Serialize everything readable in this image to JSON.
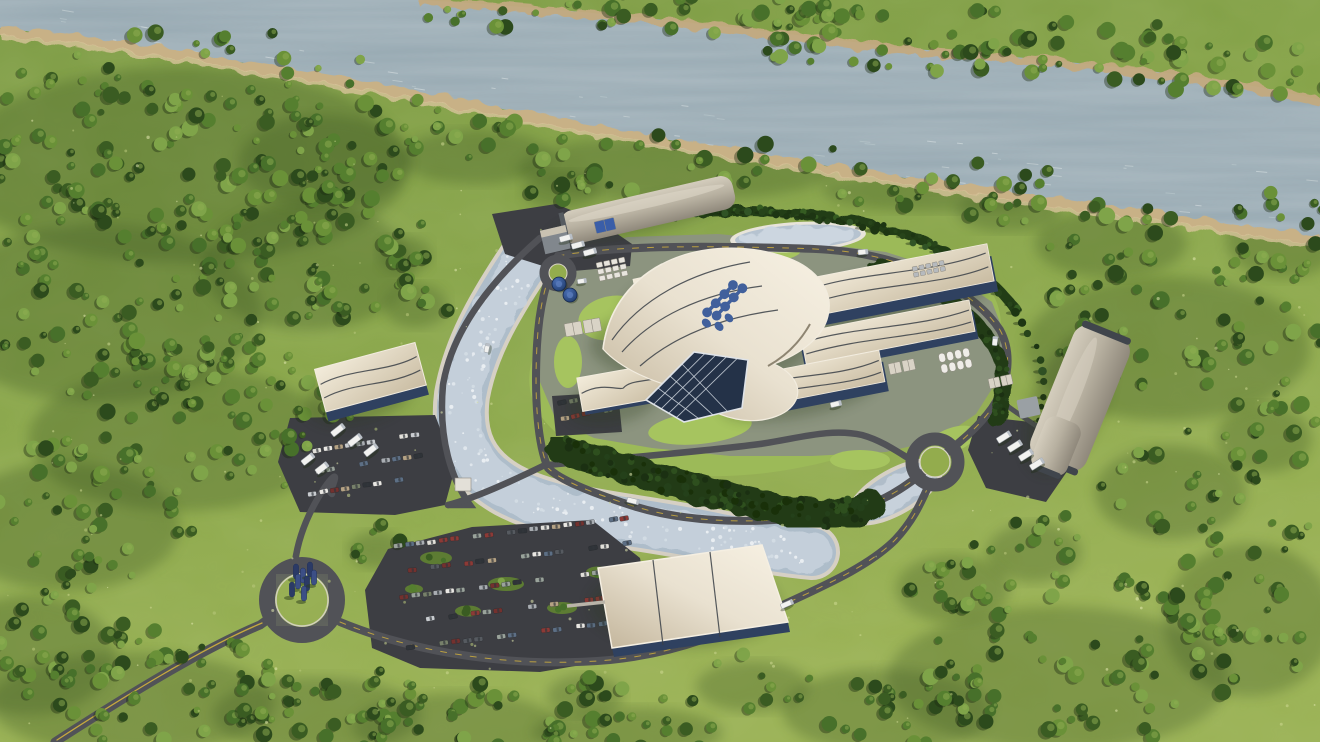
{
  "scene": {
    "name": "nuclear-plant-campus-aerial-render",
    "type": "3d-aerial-render",
    "description": "Photorealistic aerial 3D rendering of a small modular reactor power plant campus set in green countryside beside a wide river. An oval ring road encircles a central complex of cream wave-roofed buildings with a blue molecule logo on the main shell roof, a curved cooling channel, retention ponds, hedge bands, tall tree rows, gray vaulted warehouses with truck docks, a sail-roofed building, large car parks and three roundabouts, one with a blue sculpture. Dense forest surrounds the site and lines both river banks.",
    "seed": 20240817
  },
  "colors": {
    "grass_dark": "#7b9a43",
    "grass_mid": "#8aa74a",
    "grass_light": "#9ab254",
    "shadow_green": "#3a5422",
    "river_water": "#97a9b2",
    "river_light": "#c6d1d5",
    "shore_rock": "#c3aa80",
    "shore_sand": "#d8c49b",
    "far_forest": "#375722",
    "road_asphalt": "#515257",
    "road_line_yellow": "#d4b33c",
    "parking_asphalt": "#3d3e43",
    "campus_pad": "#8c947f",
    "campus_lawn": "#9cba58",
    "lawn_bright": "#a6c45f",
    "hedge_dark": "#223a16",
    "channel_stone": "#d6d0c4",
    "channel_water": "#aebdca",
    "channel_ice": "#c9d3dd",
    "roof_beige_light": "#efe8d6",
    "roof_beige": "#cdc0a8",
    "roof_seam": "#3a3f46",
    "glass_blue": "#2f4160",
    "hangar_gray": "#cfc8b9",
    "hangar_gray_dark": "#99927f",
    "container_white": "#e8e5de",
    "tank_blue": "#2e4f8e",
    "logo_blue": "#41609c",
    "sculpture_blue": "#3c4f86",
    "truck_white": "#f2f2f0"
  },
  "forest_patches": [
    [
      210,
      140,
      240,
      115,
      120
    ],
    [
      120,
      290,
      170,
      105,
      90
    ],
    [
      200,
      420,
      160,
      85,
      75
    ],
    [
      80,
      510,
      120,
      75,
      42
    ],
    [
      320,
      250,
      110,
      75,
      46
    ],
    [
      335,
      150,
      90,
      55,
      28
    ],
    [
      40,
      640,
      90,
      70,
      32
    ],
    [
      150,
      690,
      150,
      60,
      50
    ],
    [
      330,
      705,
      110,
      45,
      32
    ],
    [
      470,
      718,
      110,
      40,
      30
    ],
    [
      640,
      726,
      100,
      30,
      20
    ],
    [
      900,
      700,
      110,
      50,
      28
    ],
    [
      1080,
      660,
      180,
      85,
      70
    ],
    [
      1260,
      600,
      90,
      90,
      34
    ],
    [
      1180,
      480,
      80,
      55,
      24
    ],
    [
      1185,
      330,
      150,
      85,
      55
    ],
    [
      1120,
      235,
      80,
      40,
      18
    ],
    [
      1290,
      230,
      60,
      45,
      16
    ],
    [
      700,
      160,
      170,
      38,
      24
    ],
    [
      485,
      150,
      80,
      32,
      14
    ],
    [
      950,
      185,
      120,
      25,
      16
    ],
    [
      565,
      185,
      40,
      22,
      8
    ],
    [
      1015,
      205,
      55,
      25,
      9
    ],
    [
      1270,
      430,
      50,
      40,
      13
    ],
    [
      960,
      580,
      60,
      40,
      15
    ],
    [
      760,
      680,
      60,
      30,
      9
    ],
    [
      590,
      690,
      40,
      25,
      8
    ],
    [
      420,
      300,
      34,
      26,
      7
    ],
    [
      408,
      250,
      28,
      22,
      5
    ],
    [
      1040,
      545,
      50,
      35,
      11
    ],
    [
      380,
      545,
      30,
      22,
      6
    ]
  ],
  "far_bank_patches": [
    [
      640,
      14,
      230,
      20,
      38
    ],
    [
      980,
      40,
      250,
      34,
      58
    ],
    [
      1230,
      62,
      140,
      36,
      32
    ]
  ],
  "tree_palette": [
    "#2c4a1c",
    "#3a5c22",
    "#47702a",
    "#557f2f",
    "#6a9138",
    "#7fa449"
  ],
  "scatter": {
    "tree_row": {
      "path": "g-treerow",
      "n": 46,
      "spread": 2,
      "rmin": 2.5,
      "rmax": 4.5,
      "even": true,
      "shadow": true,
      "palette": [
        "#1d3513",
        "#27441a",
        "#315426"
      ]
    },
    "hedge_s": {
      "path": "g-hedges",
      "n": 120,
      "spread": 13,
      "rmin": 2,
      "rmax": 4.2,
      "palette": [
        "#1b3012",
        "#24401a",
        "#2e4f1e",
        "#193009"
      ]
    },
    "hedge_ne": {
      "path": "g-hedgene",
      "n": 55,
      "spread": 5,
      "rmin": 1.8,
      "rmax": 3.4,
      "palette": [
        "#1b3012",
        "#24401a",
        "#2e4f1e"
      ]
    },
    "hedge_n": {
      "path": "g-hedgen",
      "n": 75,
      "spread": 4,
      "rmin": 1.8,
      "rmax": 3.4,
      "palette": [
        "#1d3513",
        "#27441a",
        "#355c22"
      ]
    },
    "river_sparkle": {
      "path": "g-river",
      "n": 90,
      "spread": 40,
      "dash": true,
      "palette": [
        "#cfd8da",
        "#bccacd",
        "#dde4e5"
      ],
      "opacity": 0.55
    },
    "channel_speckle": {
      "path": "g-channel",
      "n": 150,
      "spread": 17,
      "rmin": 0.7,
      "rmax": 2.1,
      "palette": [
        "#e6ebf0",
        "#d6dee6",
        "#f2f5f8"
      ],
      "opacity": 0.8
    }
  },
  "flecks": {
    "n": 260,
    "rmin": 0.6,
    "rmax": 1.7,
    "colors": [
      "#cdd892",
      "#e4eab0",
      "#b9c87c"
    ],
    "opacity": 0.55
  },
  "parking_lots": [
    {
      "name": "main-parking-lot",
      "x": 398,
      "y": 546,
      "angle": -7,
      "rows": 5,
      "cols": 21,
      "px": 11.4,
      "py": 25.5,
      "occ": 0.7
    },
    {
      "name": "warehouse-parking-lot",
      "x": 306,
      "y": 452,
      "angle": -9,
      "rows": 3,
      "cols": 11,
      "px": 11,
      "py": 21,
      "occ": 0.72
    },
    {
      "name": "visitor-parking-lot",
      "x": 562,
      "y": 403,
      "angle": -10,
      "rows": 2,
      "cols": 5,
      "px": 11,
      "py": 15,
      "occ": 0.85
    }
  ],
  "car_colors": [
    "#e9e7e3",
    "#c9ccd0",
    "#a9adb2",
    "#565a60",
    "#2f3338",
    "#8d3a36",
    "#74312e",
    "#b5a284",
    "#77806a",
    "#5d6f85",
    "#9aa39b",
    "#e2e0da"
  ],
  "parking_islands": [
    [
      436,
      558,
      16,
      6.5
    ],
    [
      506,
      584,
      18,
      7
    ],
    [
      562,
      608,
      15,
      6
    ],
    [
      468,
      611,
      13,
      5.5
    ],
    [
      598,
      572,
      12,
      5.5
    ],
    [
      414,
      589,
      9,
      4.5
    ]
  ],
  "container_grids": [
    {
      "x": 596,
      "y": 263,
      "rows": 3,
      "cols": 4,
      "px": 7.6,
      "py": 6.8,
      "w": 6,
      "h": 5,
      "rot": -12,
      "fill": "#e8e5de"
    },
    {
      "x": 912,
      "y": 267,
      "rows": 2,
      "cols": 5,
      "px": 6.8,
      "py": 6,
      "w": 5,
      "h": 4.5,
      "rot": -12,
      "fill": "#b6babe"
    },
    {
      "x": 938,
      "y": 354,
      "rows": 2,
      "cols": 4,
      "px": 8.2,
      "py": 11,
      "w": 6.5,
      "h": 9,
      "rot": -12,
      "fill": "#efede8",
      "rx": 3
    },
    {
      "x": 564,
      "y": 324,
      "rows": 1,
      "cols": 2,
      "px": 19,
      "py": 0,
      "w": 17,
      "h": 13,
      "rot": -10,
      "fill": "#d9d3c6"
    },
    {
      "x": 888,
      "y": 364,
      "rows": 1,
      "cols": 2,
      "px": 14,
      "py": 0,
      "w": 12,
      "h": 11,
      "rot": -12,
      "fill": "#d9d3c6"
    },
    {
      "x": 988,
      "y": 379,
      "rows": 1,
      "cols": 2,
      "px": 12.5,
      "py": 0,
      "w": 11,
      "h": 10,
      "rot": -12,
      "fill": "#d9d3c6"
    },
    {
      "x": 594,
      "y": 222,
      "rows": 1,
      "cols": 1,
      "px": 0,
      "py": 0,
      "w": 20,
      "h": 12,
      "rot": -13,
      "fill": "#3a5ea8"
    }
  ],
  "dock_trucks": [
    [
      566,
      238,
      13,
      5.5,
      -15
    ],
    [
      578,
      245,
      13,
      5.5,
      -15
    ],
    [
      590,
      252,
      13,
      5.5,
      -15
    ],
    [
      338,
      430,
      15,
      6,
      -38
    ],
    [
      355,
      440,
      15,
      6,
      -38
    ],
    [
      371,
      450,
      15,
      6,
      -38
    ],
    [
      308,
      459,
      14,
      6,
      -38
    ],
    [
      322,
      468,
      14,
      6,
      -38
    ],
    [
      1004,
      437,
      15,
      6,
      -32
    ],
    [
      1015,
      446,
      15,
      6,
      -32
    ],
    [
      1026,
      455,
      15,
      6,
      -32
    ],
    [
      1037,
      464,
      15,
      6,
      -32
    ]
  ],
  "road_vehicles": [
    [
      863,
      252,
      10,
      5,
      -6
    ],
    [
      995,
      341,
      9,
      5,
      -85
    ],
    [
      633,
      501,
      12,
      5,
      14
    ],
    [
      787,
      604,
      13,
      5,
      -24
    ],
    [
      487,
      348,
      9,
      4.5,
      -78
    ],
    [
      582,
      281,
      9,
      4.5,
      -8
    ],
    [
      836,
      404,
      11,
      5,
      -14
    ]
  ],
  "blue_tanks": [
    [
      559,
      284,
      7
    ],
    [
      570,
      295,
      7
    ]
  ],
  "sculpture_bars": [
    [
      296,
      566
    ],
    [
      303,
      570
    ],
    [
      310,
      564
    ],
    [
      298,
      576
    ],
    [
      307,
      578
    ],
    [
      314,
      572
    ],
    [
      292,
      584
    ],
    [
      304,
      588
    ]
  ]
}
